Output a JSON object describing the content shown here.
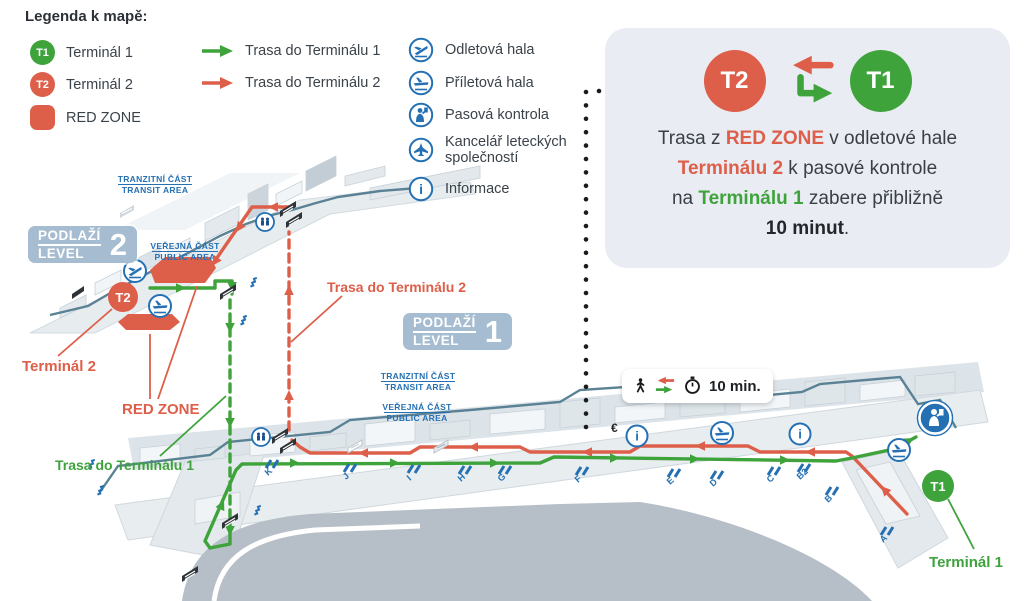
{
  "legend": {
    "title": "Legenda k mapě:",
    "terminal1": {
      "badge": "T1",
      "label": "Terminál 1"
    },
    "terminal2": {
      "badge": "T2",
      "label": "Terminál 2"
    },
    "red_zone": {
      "label": "RED ZONE"
    },
    "route1": {
      "label": "Trasa do Terminálu 1"
    },
    "route2": {
      "label": "Trasa do Terminálu 2"
    },
    "facilities": [
      {
        "icon": "departure-hall-icon",
        "label": "Odletová hala"
      },
      {
        "icon": "arrival-hall-icon",
        "label": "Příletová hala"
      },
      {
        "icon": "passport-control-icon",
        "label": "Pasová kontrola"
      },
      {
        "icon": "airline-offices-icon",
        "label": "Kancelář leteckých společností"
      },
      {
        "icon": "information-icon",
        "label": "Informace"
      }
    ]
  },
  "info_panel": {
    "t2_badge": "T2",
    "t1_badge": "T1",
    "line1_pre": "Trasa z ",
    "line1_red": "RED ZONE",
    "line1_post": " v odletové hale",
    "line2_red": "Terminálu 2",
    "line2_post": " k pasové kontrole",
    "line3_pre": "na ",
    "line3_green": "Terminálu 1",
    "line3_post": " zabere přibližně",
    "line4_bold": "10 minut",
    "line4_end": "."
  },
  "map": {
    "level2": {
      "floor_word": "PODLAŽÍ",
      "level_word": "LEVEL",
      "number": "2",
      "transit_line1": "TRANZITNÍ ČÁST",
      "transit_line2": "TRANSIT AREA",
      "public_line1": "VEŘEJNÁ ČÁST",
      "public_line2": "PUBLIC AREA",
      "t2_badge": "T2",
      "terminal2_label": "Terminál 2",
      "red_zone_label": "RED ZONE",
      "route2_label": "Trasa do Terminálu 2"
    },
    "level1": {
      "floor_word": "PODLAŽÍ",
      "level_word": "LEVEL",
      "number": "1",
      "transit_line1": "TRANZITNÍ ČÁST",
      "transit_line2": "TRANSIT AREA",
      "public_line1": "VEŘEJNÁ ČÁST",
      "public_line2": "PUBLIC AREA",
      "t1_badge": "T1",
      "terminal1_label": "Terminál 1",
      "route1_label": "Trasa do Terminálu 1",
      "time_badge": "10 min.",
      "currency_symbol": "€",
      "gates": [
        "K",
        "J",
        "I",
        "H",
        "G",
        "F",
        "E",
        "D",
        "C",
        "B2",
        "B",
        "A"
      ]
    }
  },
  "colors": {
    "green": "#3fa33c",
    "red": "#dd5f4a",
    "blue": "#2470b3",
    "teal": "#5a8294",
    "level_badge": "#a6bcd0",
    "panel_bg": "#e9ecf3",
    "apron_gray": "#b6bfc7"
  }
}
